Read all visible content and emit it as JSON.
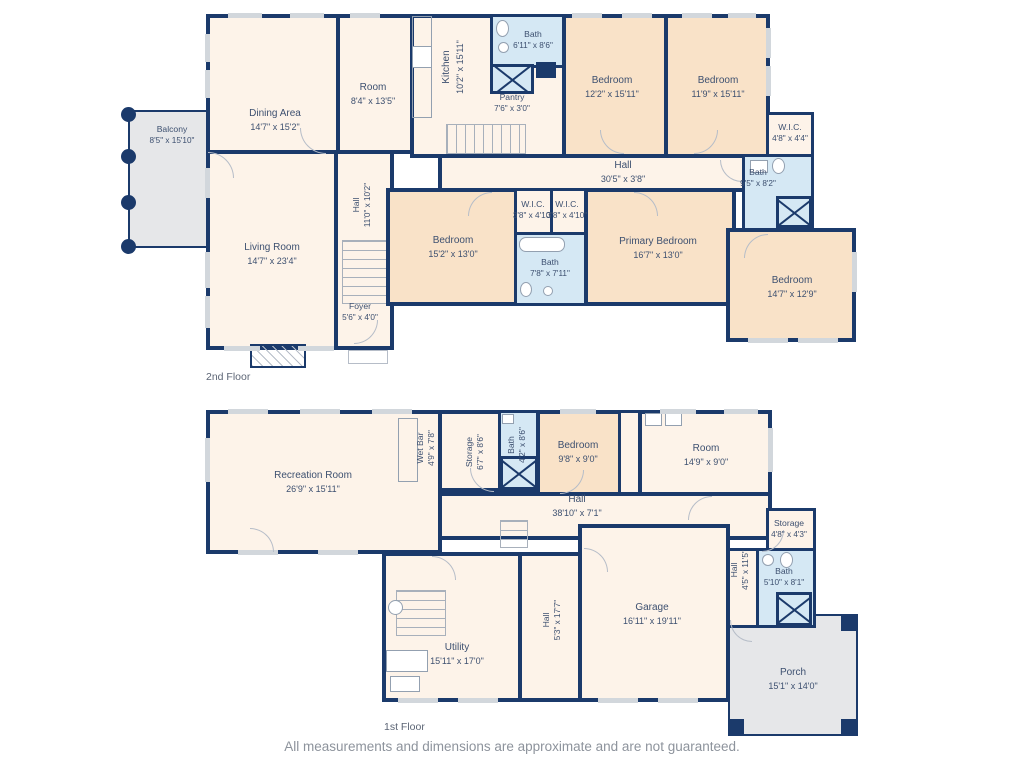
{
  "floor2": {
    "label": "2nd Floor",
    "dining": {
      "name": "Dining Area",
      "dims": "14'7\" x 15'2\""
    },
    "room": {
      "name": "Room",
      "dims": "8'4\" x 13'5\""
    },
    "kitchen": {
      "name": "Kitchen",
      "dims": "10'2\" x 15'11\""
    },
    "bath_top": {
      "name": "Bath",
      "dims": "6'11\" x 8'6\""
    },
    "pantry": {
      "name": "Pantry",
      "dims": "7'6\" x 3'0\""
    },
    "bedroom1": {
      "name": "Bedroom",
      "dims": "12'2\" x 15'11\""
    },
    "bedroom2": {
      "name": "Bedroom",
      "dims": "11'9\" x 15'11\""
    },
    "wic_right": {
      "name": "W.I.C.",
      "dims": "4'8\" x 4'4\""
    },
    "hall_main": {
      "name": "Hall",
      "dims": "30'5\" x 3'8\""
    },
    "bath_right": {
      "name": "Bath",
      "dims": "9'5\" x 8'2\""
    },
    "balcony": {
      "name": "Balcony",
      "dims": "8'5\" x 15'10\""
    },
    "living": {
      "name": "Living Room",
      "dims": "14'7\" x 23'4\""
    },
    "hall_vert": {
      "name": "Hall",
      "dims": "11'0\" x 10'2\""
    },
    "foyer": {
      "name": "Foyer",
      "dims": "5'6\" x 4'0\""
    },
    "bedroom3": {
      "name": "Bedroom",
      "dims": "15'2\" x 13'0\""
    },
    "wic1": {
      "name": "W.I.C.",
      "dims": "3'8\" x 4'10\""
    },
    "wic2": {
      "name": "W.I.C.",
      "dims": "3'8\" x 4'10\""
    },
    "bath_mid": {
      "name": "Bath",
      "dims": "7'8\" x 7'11\""
    },
    "primary": {
      "name": "Primary Bedroom",
      "dims": "16'7\" x 13'0\""
    },
    "bedroom4": {
      "name": "Bedroom",
      "dims": "14'7\" x 12'9\""
    }
  },
  "floor1": {
    "label": "1st Floor",
    "recreation": {
      "name": "Recreation Room",
      "dims": "26'9\" x 15'11\""
    },
    "wetbar": {
      "name": "Wet Bar",
      "dims": "4'9\" x 7'8\""
    },
    "storage1": {
      "name": "Storage",
      "dims": "6'7\" x 8'6\""
    },
    "bath1": {
      "name": "Bath",
      "dims": "4'2\" x 8'6\""
    },
    "bedroom": {
      "name": "Bedroom",
      "dims": "9'8\" x 9'0\""
    },
    "room": {
      "name": "Room",
      "dims": "14'9\" x 9'0\""
    },
    "hall_main": {
      "name": "Hall",
      "dims": "38'10\" x 7'1\""
    },
    "storage2": {
      "name": "Storage",
      "dims": "4'8\" x 4'3\""
    },
    "hall_side": {
      "name": "Hall",
      "dims": "4'5\" x 11'5\""
    },
    "bath2": {
      "name": "Bath",
      "dims": "5'10\" x 8'1\""
    },
    "porch": {
      "name": "Porch",
      "dims": "15'1\" x 14'0\""
    },
    "garage": {
      "name": "Garage",
      "dims": "16'11\" x 19'11\""
    },
    "hall_vert": {
      "name": "Hall",
      "dims": "5'3\" x 17'7\""
    },
    "utility": {
      "name": "Utility",
      "dims": "15'11\" x 17'0\""
    }
  },
  "footer": "All measurements and dimensions are approximate and are not guaranteed.",
  "colors": {
    "wall": "#1b3a6b",
    "bedroom_fill": "#f9e2c8",
    "room_fill": "#fdf3e9",
    "bath_fill": "#d5e8f4",
    "outdoor_fill": "#e6e7e9",
    "label_text": "#3d5070",
    "footer_text": "#8d939c"
  }
}
